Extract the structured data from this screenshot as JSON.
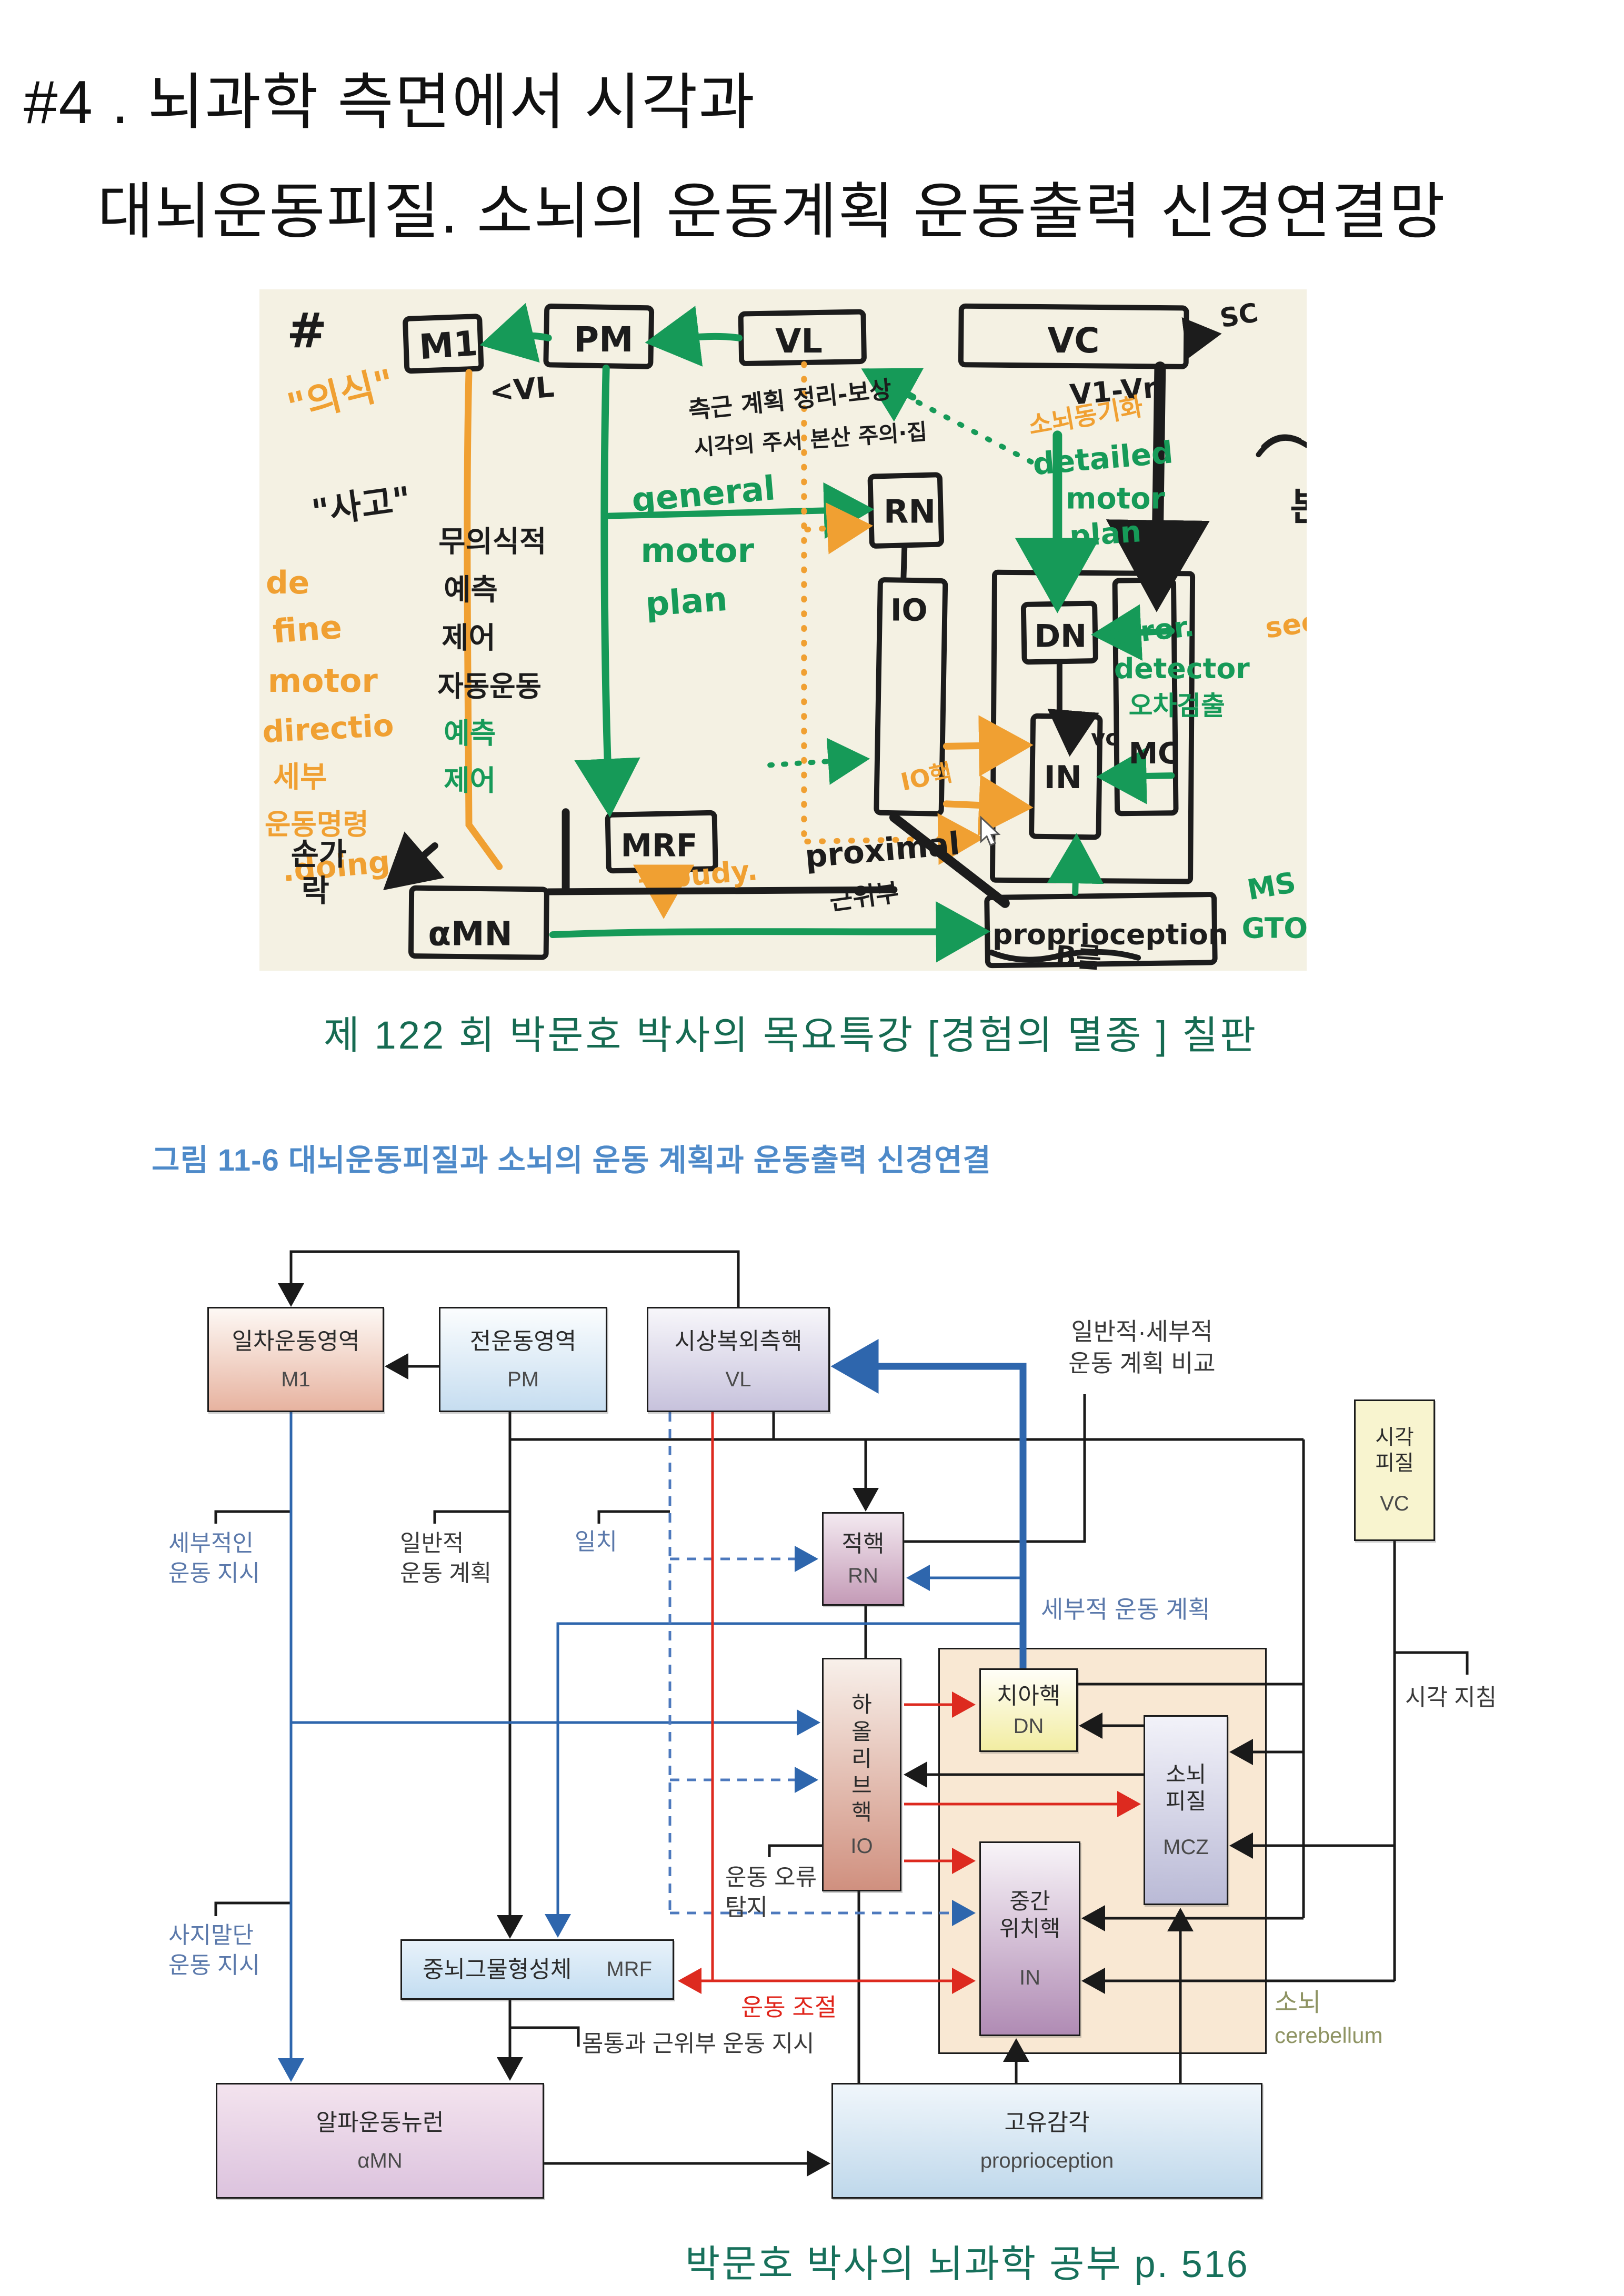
{
  "title": {
    "line1": "#4 . 뇌과학 측면에서 시각과",
    "line2": "대뇌운동피질. 소뇌의 운동계획 운동출력 신경연결망"
  },
  "captions": {
    "board": "제 122 회 박문호 박사의 목요특강 [경험의 멸종 ] 칠판",
    "source": "박문호 박사의 뇌과학  공부 p.  516"
  },
  "whiteboard": {
    "hash": "#",
    "boxes": {
      "m1": "M1",
      "pm": "PM",
      "vl": "VL",
      "vc": "VC",
      "rn": "RN",
      "dn": "DN",
      "io": "IO",
      "in": "IN",
      "mc": "MC",
      "mrf": "MRF",
      "amn": "αMN",
      "prop": "proprioception"
    },
    "labels": {
      "uisik": "\"의식\"",
      "sago": "\"사고\"",
      "de": "de",
      "fine": "fine",
      "motor": "motor",
      "directio": "directio",
      "sebu": "세부",
      "command": "운동명령",
      "doing": ".doing",
      "songa": "손가",
      "rak": "락",
      "muuisik": "무의식적",
      "yecheuk": "예측",
      "jeeo": "제어",
      "jadong": "자동운동",
      "g_yecheuk": "예측",
      "g_jeeo": "제어",
      "general1": "general",
      "general2": "motor",
      "general3": "plan",
      "vl_note": "<VL",
      "cluster1": "측근 계획 정리-보상",
      "cluster2": "시각의 주서 본산 주의·집",
      "sonoe_sync": "소뇌동기화",
      "detailed1": "detailed",
      "detailed2": "motor",
      "detailed3": "plan",
      "v1vn": "V1-Vn",
      "sc": "SC",
      "bon": "본",
      "da": "다",
      "seeing": "seeing",
      "error1": "error.",
      "error2": "detector",
      "error3": "오차검출",
      "io_haek": "IO핵",
      "vc_small": "vc",
      "proximal": "proximal",
      "geonwibu": "근위부",
      "ms": "MS",
      "gto": "GTO",
      "budy": "→ budy.",
      "brum": "B름"
    }
  },
  "figure": {
    "caption": "그림 11-6 대뇌운동피질과 소뇌의 운동 계획과 운동출력 신경연결",
    "boxes": {
      "m1": {
        "name": "일차운동영역",
        "code": "M1"
      },
      "pm": {
        "name": "전운동영역",
        "code": "PM"
      },
      "vl": {
        "name": "시상복외측핵",
        "code": "VL"
      },
      "vc": {
        "name": "시각\n피질",
        "code": "VC"
      },
      "rn": {
        "name": "적핵",
        "code": "RN"
      },
      "io": {
        "name": "하\n올\n리\n브\n핵",
        "code": "IO"
      },
      "dn": {
        "name": "치아핵",
        "code": "DN"
      },
      "mcz": {
        "name": "소뇌\n피질",
        "code": "MCZ"
      },
      "in": {
        "name": "중간\n위치핵",
        "code": "IN"
      },
      "mrf": {
        "name": "중뇌그물형성체",
        "code": "MRF"
      },
      "amn": {
        "name": "알파운동뉴런",
        "code": "αMN"
      },
      "prop": {
        "name": "고유감각",
        "code": "proprioception"
      }
    },
    "labels": {
      "compare": "일반적·세부적\n운동 계획 비교",
      "detail_instr": "세부적인\n운동 지시",
      "general_plan": "일반적\n운동 계획",
      "match": "일치",
      "detail_plan": "세부적 운동 계획",
      "visual_guide": "시각 지침",
      "error_detect": "운동 오류\n탐지",
      "motor_control": "운동 조절",
      "limb_instr": "사지말단\n운동 지시",
      "trunk_instr": "몸통과 근위부 운동 지시",
      "cerebellum_ko": "소뇌",
      "cerebellum_en": "cerebellum"
    }
  },
  "colors": {
    "caption_green": "#166b52",
    "caption_blue": "#4e8ac9",
    "marker_green": "#169a58",
    "marker_orange": "#f0a032",
    "arrow_blue": "#2e66ad",
    "arrow_red": "#dd2a1f"
  }
}
